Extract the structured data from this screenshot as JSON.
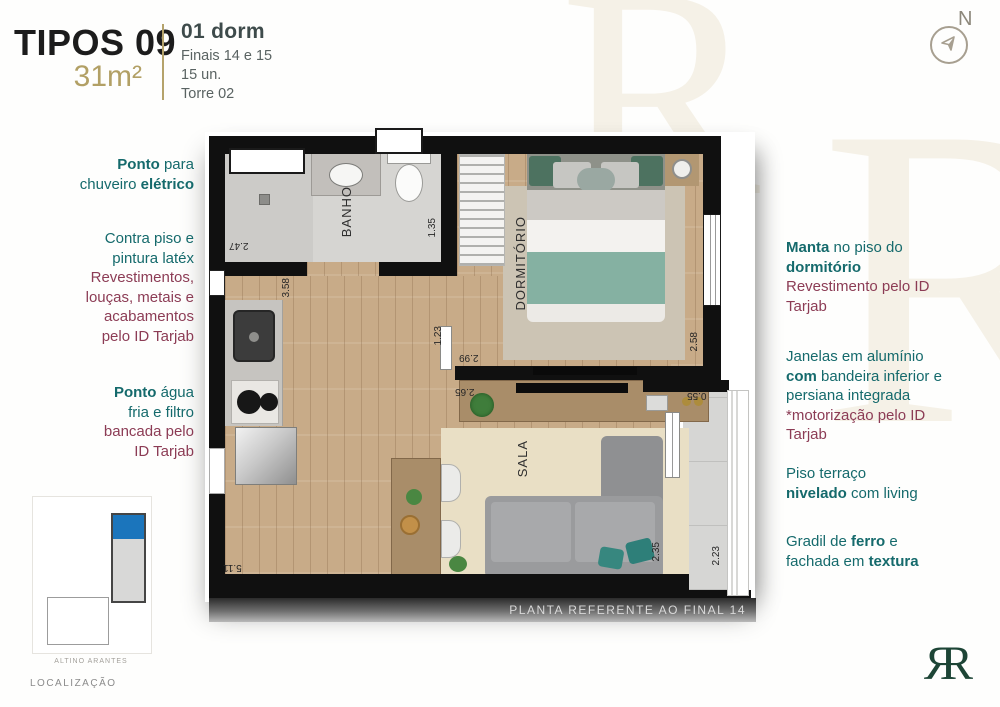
{
  "header": {
    "type_label": "TIPOS 09",
    "area_label": "31m²",
    "unit_info": {
      "line1": "01 dorm",
      "line2": "Finais 14 e 15",
      "line3": "15 un.",
      "line4": "Torre 02"
    },
    "compass_label": "N"
  },
  "annotations_left": [
    {
      "lines": [
        [
          {
            "t": "Ponto",
            "b": true
          },
          {
            "t": " para"
          }
        ],
        [
          {
            "t": "chuveiro "
          },
          {
            "t": "elétrico",
            "b": true
          }
        ]
      ]
    },
    {
      "lines": [
        [
          {
            "t": "Contra piso e"
          }
        ],
        [
          {
            "t": "pintura latéx"
          }
        ],
        [
          {
            "t": "Revestimentos,",
            "c": "maroon"
          }
        ],
        [
          {
            "t": "louças, metais e",
            "c": "maroon"
          }
        ],
        [
          {
            "t": "acabamentos",
            "c": "maroon"
          }
        ],
        [
          {
            "t": "pelo ID Tarjab",
            "c": "maroon"
          }
        ]
      ]
    },
    {
      "lines": [
        [
          {
            "t": "Ponto",
            "b": true
          },
          {
            "t": " água"
          }
        ],
        [
          {
            "t": "fria e filtro"
          }
        ],
        [
          {
            "t": "bancada pelo",
            "c": "maroon"
          }
        ],
        [
          {
            "t": "ID Tarjab",
            "c": "maroon"
          }
        ]
      ]
    }
  ],
  "annotations_right": [
    {
      "lines": [
        [
          {
            "t": "Manta",
            "b": true
          },
          {
            "t": " no piso do"
          }
        ],
        [
          {
            "t": "dormitório",
            "b": true
          }
        ],
        [
          {
            "t": "Revestimento pelo ID",
            "c": "maroon"
          }
        ],
        [
          {
            "t": "Tarjab",
            "c": "maroon"
          }
        ]
      ]
    },
    {
      "lines": [
        [
          {
            "t": "Janelas em alumínio"
          }
        ],
        [
          {
            "t": "com",
            "b": true
          },
          {
            "t": " bandeira inferior e"
          }
        ],
        [
          {
            "t": "persiana integrada"
          }
        ],
        [
          {
            "t": "*motorização pelo ID",
            "c": "maroon"
          }
        ],
        [
          {
            "t": "Tarjab",
            "c": "maroon"
          }
        ]
      ]
    },
    {
      "lines": [
        [
          {
            "t": "Piso terraço"
          }
        ],
        [
          {
            "t": "nivelado",
            "b": true
          },
          {
            "t": " com living"
          }
        ]
      ]
    },
    {
      "lines": [
        [
          {
            "t": "Gradil de "
          },
          {
            "t": "ferro",
            "b": true
          },
          {
            "t": " e"
          }
        ],
        [
          {
            "t": "fachada em "
          },
          {
            "t": "textura",
            "b": true
          }
        ]
      ]
    }
  ],
  "plan": {
    "rooms": {
      "banho": "BANHO",
      "dormitorio": "DORMITÓRIO",
      "sala": "SALA"
    },
    "dims": {
      "shower_w": "2.47",
      "banho_h": "1.35",
      "kitchen_h": "3.58",
      "hall_w": "1.23",
      "dorm_w": "2.99",
      "console_w": "2.65",
      "dorm_h": "2.58",
      "terrace_w": "0.55",
      "sala_w": "5.11",
      "sala_h": "2.35",
      "terrace_h": "2.23"
    },
    "footer_note": "PLANTA REFERENTE AO FINAL 14"
  },
  "localization": {
    "title": "LOCALIZAÇÃO",
    "street": "ALTINO ARANTES"
  },
  "logo": {
    "left_letter": "R",
    "right_letter": "R"
  },
  "colors": {
    "teal": "#156a6c",
    "maroon": "#8c3c55",
    "gold": "#b2a065",
    "tower_blue": "#1b75bc",
    "logo_green": "#1d4536"
  }
}
